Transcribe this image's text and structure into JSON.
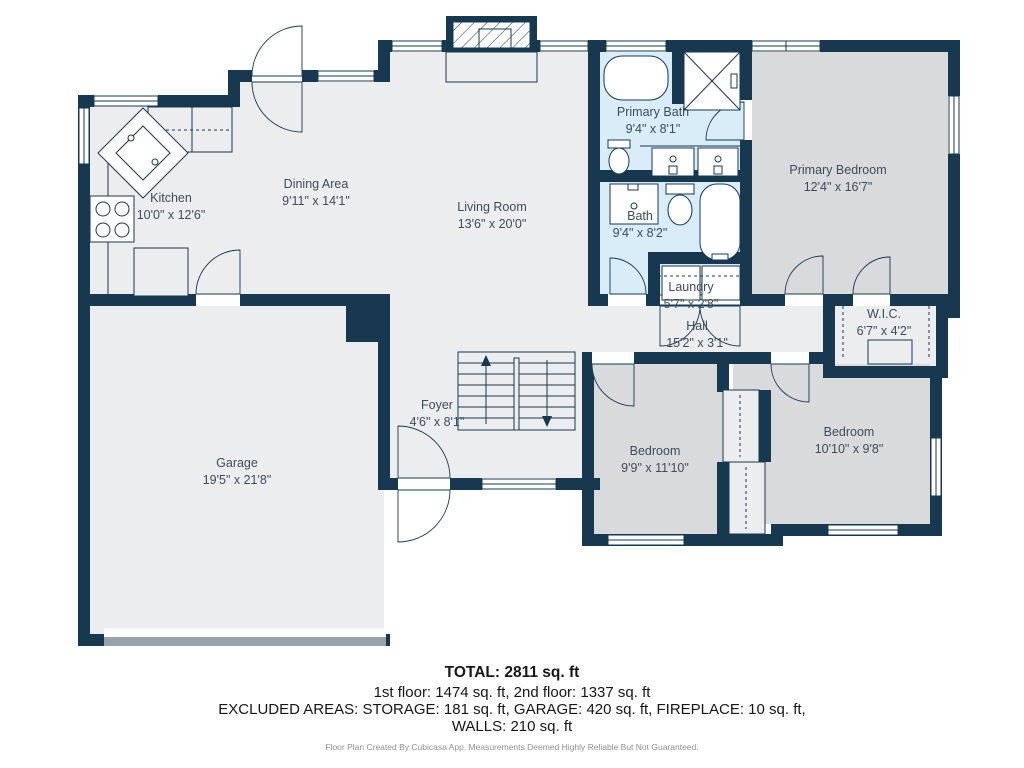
{
  "plan": {
    "rooms": [
      {
        "name": "Kitchen",
        "dims": "10'0\" x 12'6\""
      },
      {
        "name": "Dining Area",
        "dims": "9'11\" x 14'1\""
      },
      {
        "name": "Living Room",
        "dims": "13'6\" x 20'0\""
      },
      {
        "name": "Primary Bath",
        "dims": "9'4\" x 8'1\""
      },
      {
        "name": "Primary Bedroom",
        "dims": "12'4\" x 16'7\""
      },
      {
        "name": "Bath",
        "dims": "9'4\" x 8'2\""
      },
      {
        "name": "Laundry",
        "dims": "5'7\" x 2'8\""
      },
      {
        "name": "W.I.C.",
        "dims": "6'7\" x 4'2\""
      },
      {
        "name": "Hall",
        "dims": "15'2\" x 3'1\""
      },
      {
        "name": "Foyer",
        "dims": "4'6\" x 8'1\""
      },
      {
        "name": "Garage",
        "dims": "19'5\" x 21'8\""
      },
      {
        "name": "Bedroom",
        "dims": "9'9\" x 11'10\""
      },
      {
        "name": "Bedroom",
        "dims": "10'10\" x 9'8\""
      }
    ],
    "summary": {
      "total": "TOTAL: 2811 sq. ft",
      "floors": "1st floor: 1474 sq. ft, 2nd floor: 1337 sq. ft",
      "excluded": "EXCLUDED AREAS: STORAGE: 181 sq. ft, GARAGE: 420 sq. ft, FIREPLACE: 10 sq. ft,",
      "excluded2": "WALLS: 210 sq. ft",
      "disclaimer": "Floor Plan Created By Cubicasa App. Measurements Deemed Highly Reliable But Not Guaranteed."
    },
    "colors": {
      "wall": "#17384f",
      "floor": "#ecedee",
      "bedroom_floor": "#d9dadc",
      "bath_floor": "#d9edf8",
      "label": "#3c4c5c",
      "garage_door": "#98a2a8"
    }
  }
}
